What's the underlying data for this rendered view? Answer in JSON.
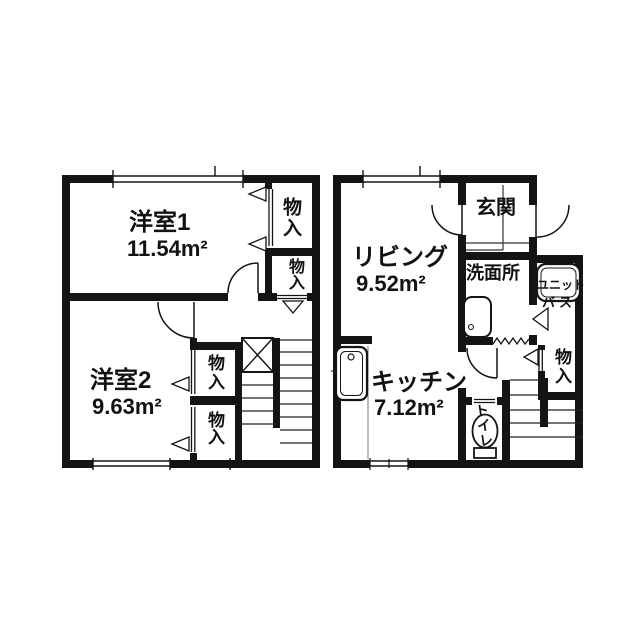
{
  "canvas": {
    "background": "#ffffff",
    "wall_color": "#141414",
    "line_color": "#222222"
  },
  "floor2": {
    "room1": {
      "name": "洋室1",
      "area": "11.54m²"
    },
    "room2": {
      "name": "洋室2",
      "area": "9.63m²"
    },
    "closet": "物入"
  },
  "floor1": {
    "living": {
      "name": "リビング",
      "area": "9.52m²"
    },
    "kitchen": {
      "name": "キッチン",
      "area": "7.12m²"
    },
    "entrance": "玄関",
    "washroom": "洗面所",
    "unit_bath": {
      "line1": "ユニット",
      "line2": "バス"
    },
    "toilet": "トイレ",
    "closet": "物入"
  }
}
